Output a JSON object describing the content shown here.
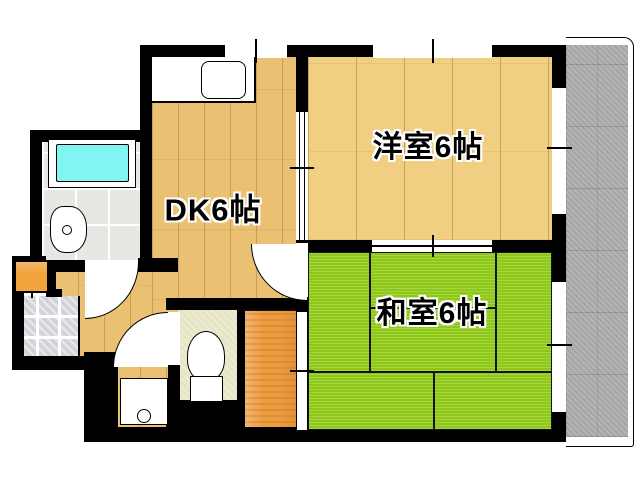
{
  "plan_title": "apartment-floorplan",
  "rooms": {
    "dk": {
      "label": "DK6帖"
    },
    "western": {
      "label": "洋室6帖"
    },
    "japanese": {
      "label": "和室6帖"
    }
  },
  "fixtures": {
    "kitchen_sink": "kitchen-sink-counter",
    "bathtub": "bathtub",
    "washbasin": "washbasin",
    "toilet": "toilet",
    "laundry_pan": "washing-machine-pan",
    "shoe_cabinet": "shoe-cabinet",
    "entrance": "genkan-tile-floor",
    "closet": "oshiire-closet",
    "balcony": "balcony"
  },
  "colors": {
    "wall": "#000000",
    "western_wood": "#F0CE82",
    "dk_wood": "#EAC172",
    "tatami_green": "#8DC814",
    "closet_orange": "#EE9C40",
    "bathtub_cyan": "#80F5F2",
    "balcony_gray": "#AFAFAF",
    "toilet_floor": "#ECEACF",
    "entrance_tile": "#D2D2D8",
    "shoe_cabinet_orange": "#F2A33C"
  }
}
